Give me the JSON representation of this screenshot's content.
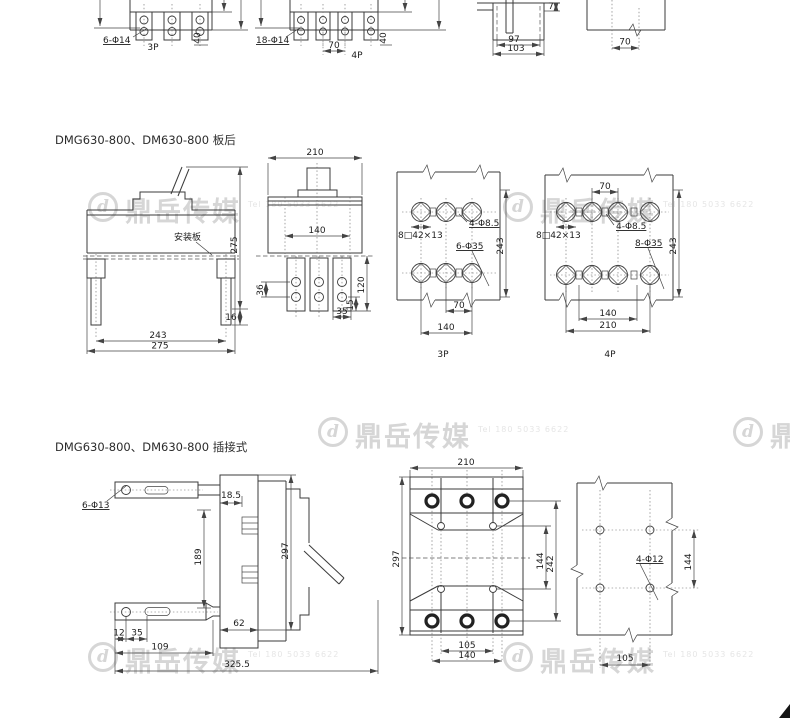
{
  "page": {
    "background": "#ffffff"
  },
  "watermark": {
    "logo_letter": "d",
    "text": "鼎岳传媒",
    "subtext": "Tel 180 5033 6622",
    "color": "#d6d6d6"
  },
  "top_row": {
    "view_3p": {
      "hole_note": "6-Φ14",
      "pole_label": "3P",
      "width_40": "40"
    },
    "view_4p": {
      "hole_note": "18-Φ14",
      "pitch_70": "70",
      "pole_label": "4P",
      "width_40": "40"
    },
    "side_view": {
      "dim_7": "7",
      "dim_97": "97",
      "dim_103": "103"
    },
    "panel_view": {
      "dim_70": "70"
    }
  },
  "rear_mount": {
    "title": "DMG630-800、DM630-800 板后",
    "front_view": {
      "mounting_plate_note": "安装板",
      "height_275": "275",
      "dim_16": "16",
      "width_243": "243",
      "width_275": "275"
    },
    "side_view": {
      "width_210": "210",
      "pitch_140": "140",
      "dim_36": "36",
      "dim_120": "120",
      "dim_15": "15",
      "dim_35": "35"
    },
    "drill_3p": {
      "slot_note": "8□42×13",
      "hole_note_small": "4-Φ8.5",
      "hole_note_large": "6-Φ35",
      "height_243": "243",
      "pitch_70": "70",
      "pitch_140": "140",
      "pole_label": "3P"
    },
    "drill_4p": {
      "pitch_70": "70",
      "slot_note": "8□42×13",
      "hole_note_small": "4-Φ8.5",
      "hole_note_large": "8-Φ35",
      "height_243": "243",
      "pitch_140": "140",
      "width_210": "210",
      "pole_label": "4P"
    }
  },
  "plug_in": {
    "title": "DMG630-800、DM630-800 插接式",
    "side_view": {
      "hole_note": "6-Φ13",
      "dim_18_5": "18.5",
      "dim_189": "189",
      "dim_297": "297",
      "dim_62": "62",
      "dim_12": "12",
      "dim_35": "35",
      "dim_109": "109",
      "dim_325_5": "325.5"
    },
    "front_view": {
      "width_210": "210",
      "height_297": "297",
      "dim_144": "144",
      "dim_242": "242",
      "pitch_105": "105",
      "pitch_140": "140"
    },
    "panel_view": {
      "hole_note": "4-Φ12",
      "dim_144": "144",
      "pitch_105": "105"
    }
  }
}
